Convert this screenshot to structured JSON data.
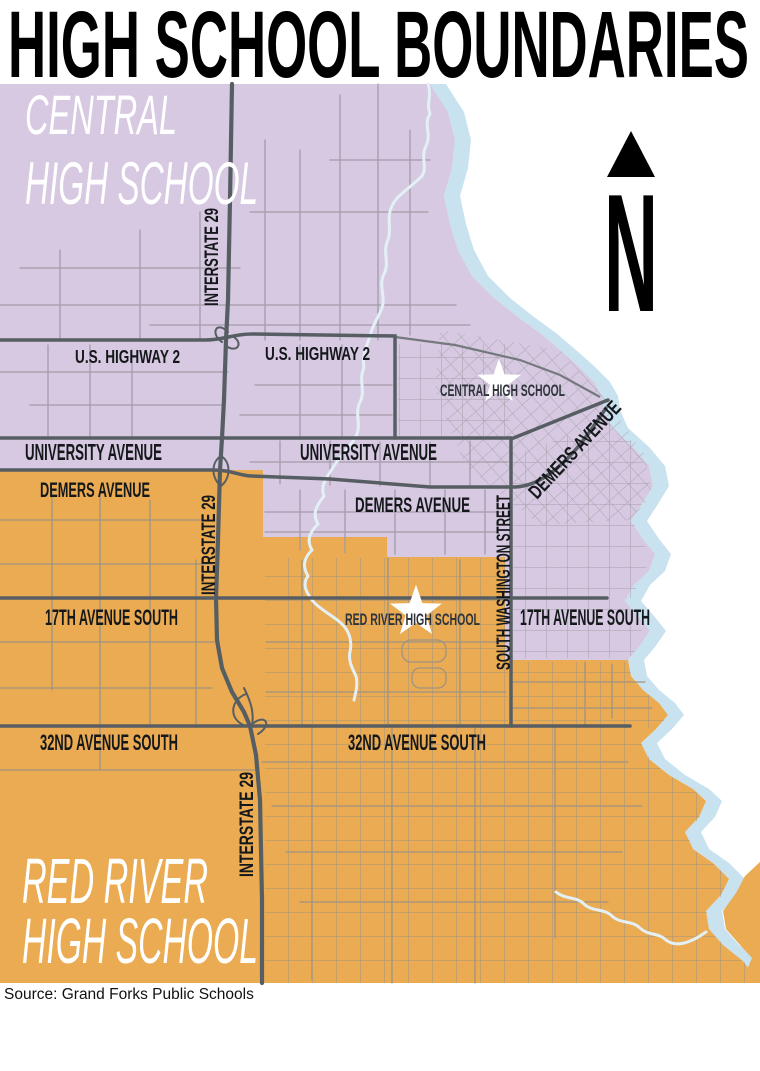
{
  "title": "HIGH SCHOOL BOUNDARIES",
  "source_note": "Source: Grand Forks Public Schools",
  "compass": {
    "letter": "N"
  },
  "regions": {
    "central": {
      "line1": "CENTRAL",
      "line2": "HIGH SCHOOL",
      "color": "#D6C9E1"
    },
    "red_river": {
      "line1": "RED RIVER",
      "line2": "HIGH SCHOOL",
      "color": "#EAAB52"
    }
  },
  "schools": {
    "central": {
      "label": "CENTRAL HIGH SCHOOL"
    },
    "red_river": {
      "label": "RED RIVER HIGH SCHOOL"
    }
  },
  "roads": {
    "us_highway_2_west": "U.S. HIGHWAY 2",
    "us_highway_2_east": "U.S. HIGHWAY 2",
    "university_avenue_west": "UNIVERSITY AVENUE",
    "university_avenue_east": "UNIVERSITY AVENUE",
    "demers_avenue_west": "DEMERS AVENUE",
    "demers_avenue_central": "DEMERS AVENUE",
    "demers_avenue_diagonal": "DEMERS AVENUE",
    "interstate_29_north": "INTERSTATE 29",
    "interstate_29_central": "INTERSTATE 29",
    "interstate_29_south": "INTERSTATE 29",
    "south_washington_street": "SOUTH WASHINGTON STREET",
    "seventeenth_avenue_west": "17TH AVENUE SOUTH",
    "seventeenth_avenue_east": "17TH AVENUE SOUTH",
    "thirty_second_avenue_west": "32ND AVENUE SOUTH",
    "thirty_second_avenue_east": "32ND AVENUE SOUTH"
  },
  "colors": {
    "central_region": "#D6C9E1",
    "red_river_region": "#EAAB52",
    "river": "#C9E2EF",
    "creek": "#E3F0F6",
    "major_road": "#575E63",
    "road_label_text": "#15181B",
    "school_label_text": "#2F343A",
    "title_text": "#000000",
    "region_label_text": "#FFFFFF"
  }
}
